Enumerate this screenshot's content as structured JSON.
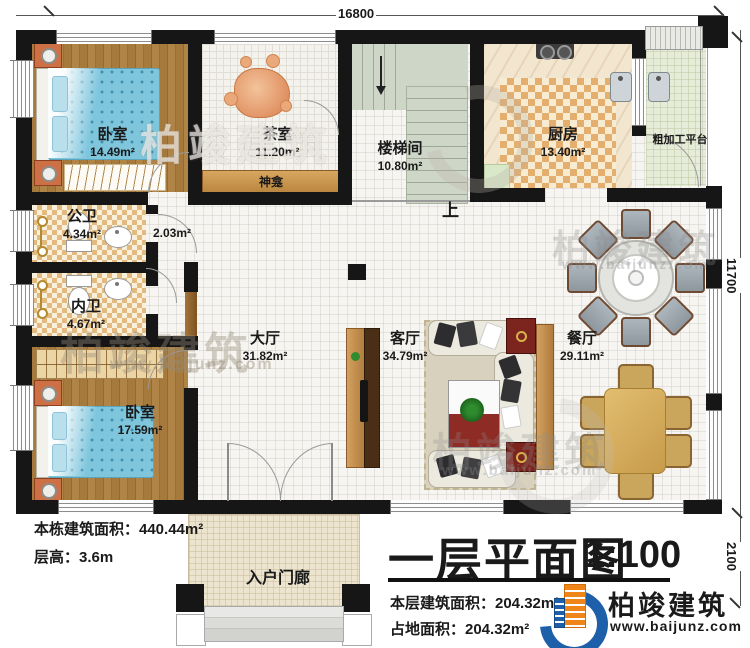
{
  "dimensions": {
    "top": "16800",
    "right": "11700",
    "corner": "2100"
  },
  "rooms": [
    {
      "name": "卧室",
      "area": "14.49m²"
    },
    {
      "name": "茶室",
      "area": "11.20m²"
    },
    {
      "name": "楼梯间",
      "area": "10.80m²"
    },
    {
      "name": "厨房",
      "area": "13.40m²"
    },
    {
      "name": "粗加工平台",
      "area": ""
    },
    {
      "name": "公卫",
      "area": "4.34m²"
    },
    {
      "name": "内卫",
      "area": "4.67m²"
    },
    {
      "name": "卧室",
      "area": "17.59m²"
    },
    {
      "name": "大厅",
      "area": "31.82m²"
    },
    {
      "name": "客厅",
      "area": "34.79m²"
    },
    {
      "name": "餐厅",
      "area": "29.11m²"
    },
    {
      "name": "入户门廊",
      "area": ""
    }
  ],
  "labels": {
    "shrine": "神龛",
    "up": "上",
    "corridor_area": "2.03m²"
  },
  "notes": {
    "building_area": "本栋建筑面积：440.44m²",
    "storey_height": "层高：3.6m"
  },
  "titleblock": {
    "title": "一层平面图",
    "scale": "1:100",
    "floor_area": "本层建筑面积：204.32m²",
    "site_area": "占地面积：204.32m²"
  },
  "brand": {
    "name": "柏竣建筑",
    "url": "www.baijunz.com"
  },
  "colors": {
    "wall": "#161616",
    "accent_blue": "#1d5fa8",
    "accent_orange": "#f08519",
    "bed": "#7fc6dd",
    "checker": "#e4ae6e"
  }
}
